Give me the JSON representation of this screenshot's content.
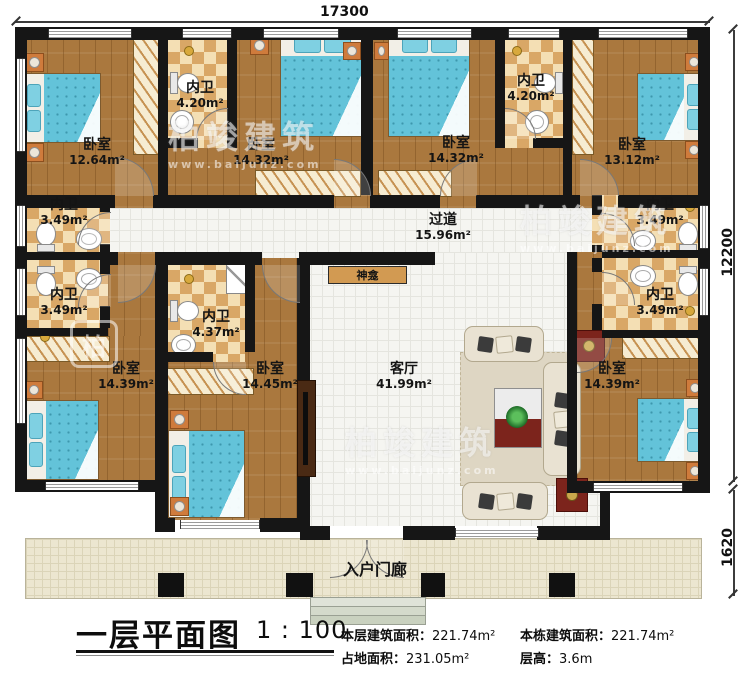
{
  "dimensions": {
    "width_top": "17300",
    "height_right": "12200",
    "porch_depth": "1620"
  },
  "rooms": {
    "bedroom_tl": {
      "label": "卧室",
      "area": "12.64m²"
    },
    "bath_t1": {
      "label": "内卫",
      "area": "4.20m²"
    },
    "bedroom_t2": {
      "label": "卧室",
      "area": "14.32m²"
    },
    "bedroom_t3": {
      "label": "卧室",
      "area": "14.32m²"
    },
    "bath_t2": {
      "label": "内卫",
      "area": "4.20m²"
    },
    "bedroom_tr": {
      "label": "卧室",
      "area": "13.12m²"
    },
    "bath_l1": {
      "label": "内卫",
      "area": "3.49m²"
    },
    "bath_l2": {
      "label": "内卫",
      "area": "3.49m²"
    },
    "bedroom_bl": {
      "label": "卧室",
      "area": "14.39m²"
    },
    "bath_c": {
      "label": "内卫",
      "area": "4.37m²"
    },
    "bedroom_bc": {
      "label": "卧室",
      "area": "14.45m²"
    },
    "corridor": {
      "label": "过道",
      "area": "15.96m²"
    },
    "shrine": {
      "label": "神龛"
    },
    "living": {
      "label": "客厅",
      "area": "41.99m²"
    },
    "bath_r1": {
      "label": "内卫",
      "area": "3.49m²"
    },
    "bath_r2": {
      "label": "内卫",
      "area": "3.49m²"
    },
    "bedroom_br": {
      "label": "卧室",
      "area": "14.39m²"
    },
    "porch": {
      "label": "入户门廊"
    }
  },
  "title_block": {
    "title": "一层平面图",
    "scale": "1 : 100",
    "stats": {
      "floor_area_label": "本层建筑面积：",
      "floor_area_value": "221.74m²",
      "building_area_label": "本栋建筑面积：",
      "building_area_value": "221.74m²",
      "footprint_label": "占地面积：",
      "footprint_value": "231.05m²",
      "height_label": "层高：",
      "height_value": "3.6m"
    }
  },
  "watermark": {
    "brand": "柏竣建筑",
    "url": "www.baijunz.com",
    "logo_char": "柏"
  },
  "colors": {
    "wall": "#161616",
    "wood_floor": "#aa783e",
    "checker_dark": "#d9a766",
    "checker_light": "#f4dfb4",
    "tile_floor": "#f5f5f1",
    "porch_floor": "#ece6d0",
    "bed_blanket": "#63c3d9",
    "accent_table": "#7c241c"
  }
}
